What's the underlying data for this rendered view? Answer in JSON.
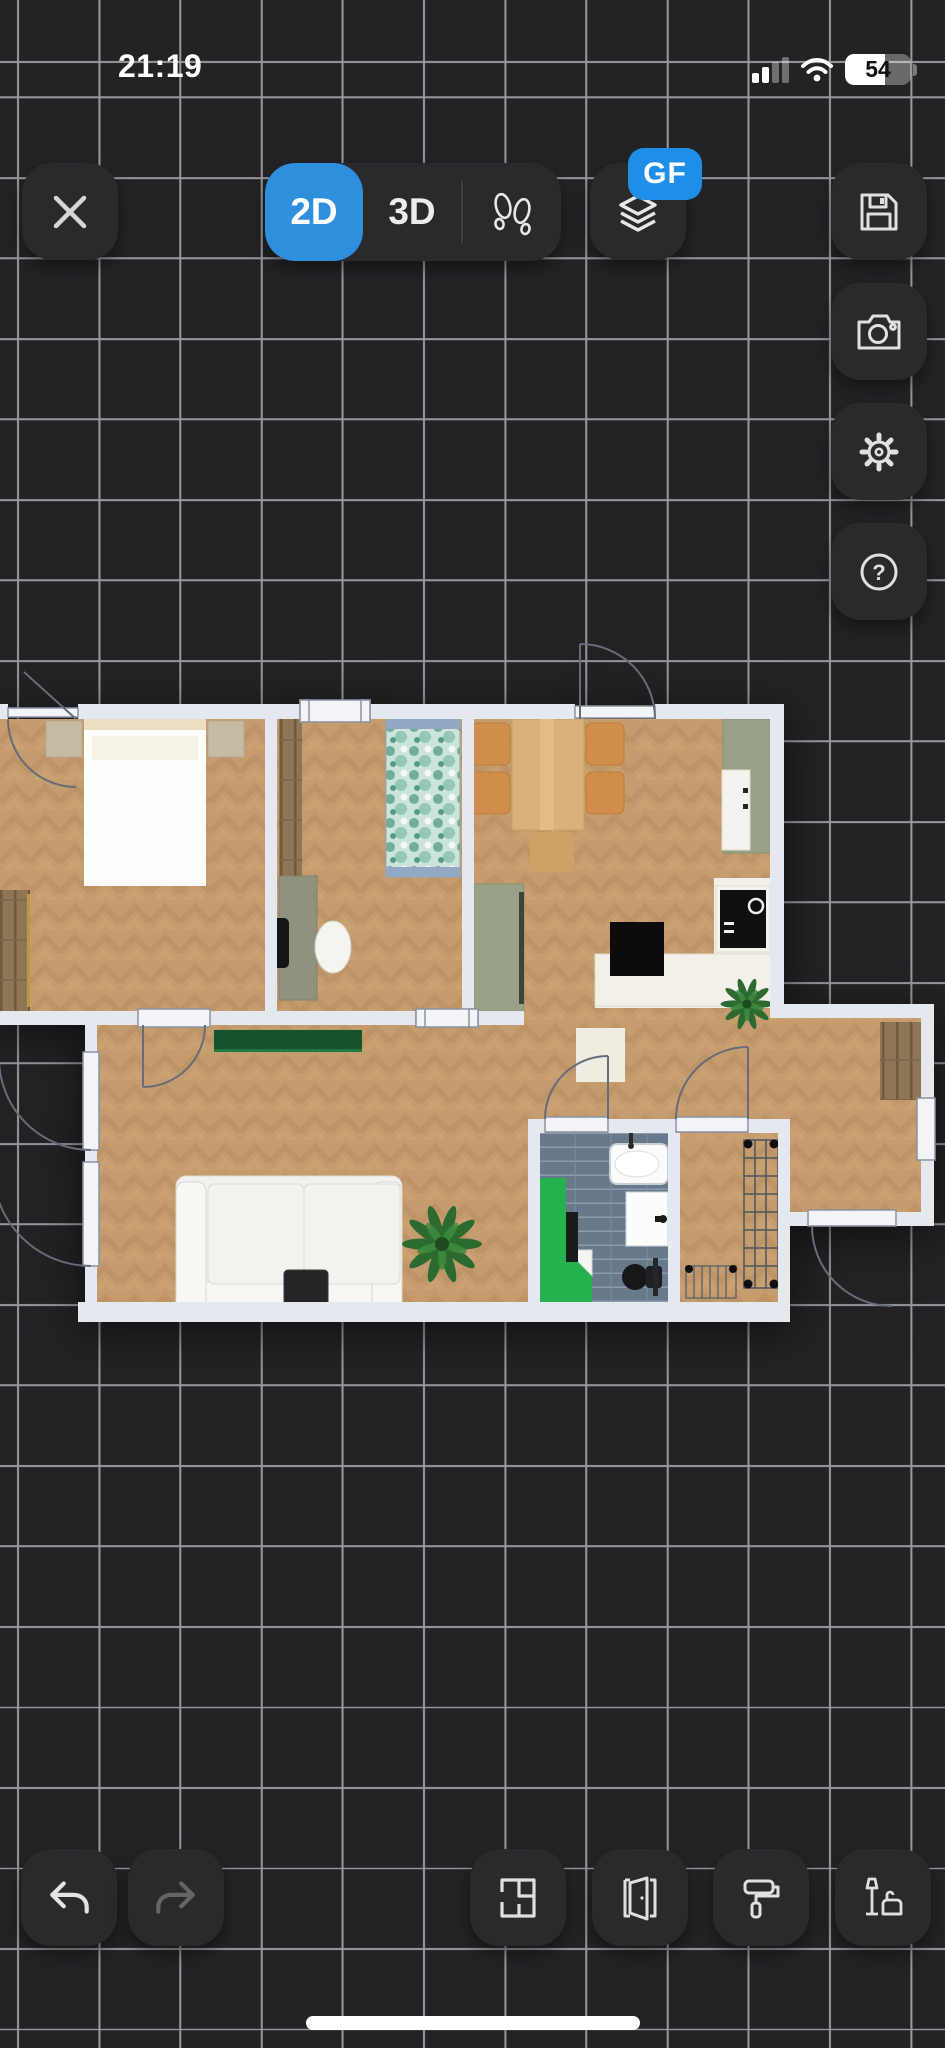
{
  "status_bar": {
    "time": "21:19",
    "battery_percent": "54",
    "icons": [
      "cellular-signal-icon",
      "wifi-icon",
      "battery-icon"
    ]
  },
  "top_toolbar": {
    "close_icon": "close-icon",
    "view_segments": [
      {
        "label": "2D",
        "active": true
      },
      {
        "label": "3D",
        "active": false
      },
      {
        "icon": "footprints-icon",
        "active": false
      }
    ],
    "floor_selector": {
      "icon": "layers-icon",
      "badge": "GF"
    },
    "side_buttons": [
      {
        "icon": "save-icon"
      },
      {
        "icon": "camera-icon"
      },
      {
        "icon": "settings-gear-icon"
      },
      {
        "icon": "help-icon",
        "glyph": "?"
      }
    ]
  },
  "bottom_toolbar": {
    "undo_icon": "undo-icon",
    "redo_icon": "redo-icon",
    "redo_disabled": true,
    "tools": [
      {
        "icon": "rooms-walls-icon"
      },
      {
        "icon": "doors-windows-icon"
      },
      {
        "icon": "paint-roller-icon"
      },
      {
        "icon": "furniture-icon"
      }
    ]
  },
  "floorplan": {
    "current_floor": "GF",
    "view_mode": "2D",
    "rooms": [
      "bedroom",
      "office",
      "kitchen-dining",
      "living-room",
      "bathroom",
      "storage",
      "entry-hall"
    ],
    "items": [
      "double-bed",
      "nightstands",
      "wardrobe",
      "desk",
      "office-chairs",
      "single-bed-teal",
      "dining-table",
      "dining-chairs",
      "pantry-cabinet",
      "kitchen-counter",
      "fridge",
      "cooktop",
      "kitchen-island",
      "plants",
      "sideboard",
      "sofa",
      "coffee-table",
      "rug",
      "bathtub",
      "sink",
      "toilet",
      "shower",
      "drying-racks",
      "entry-wardrobe"
    ]
  },
  "colors": {
    "accent": "#2f8fdd",
    "badge": "#1f8ee8",
    "bg": "#232326",
    "grid": "#97989c",
    "btn": "#2a2a2d",
    "icon": "#e0e0e2",
    "wall": "#e4e8ef",
    "slab": "#f2f4f7",
    "wood": "#c59c6e",
    "tile": "#68798b",
    "shower_green": "#25b14d",
    "sideboard_green": "#14532d",
    "counter_sage": "#99a186",
    "chair_orange": "#d08d4c"
  }
}
